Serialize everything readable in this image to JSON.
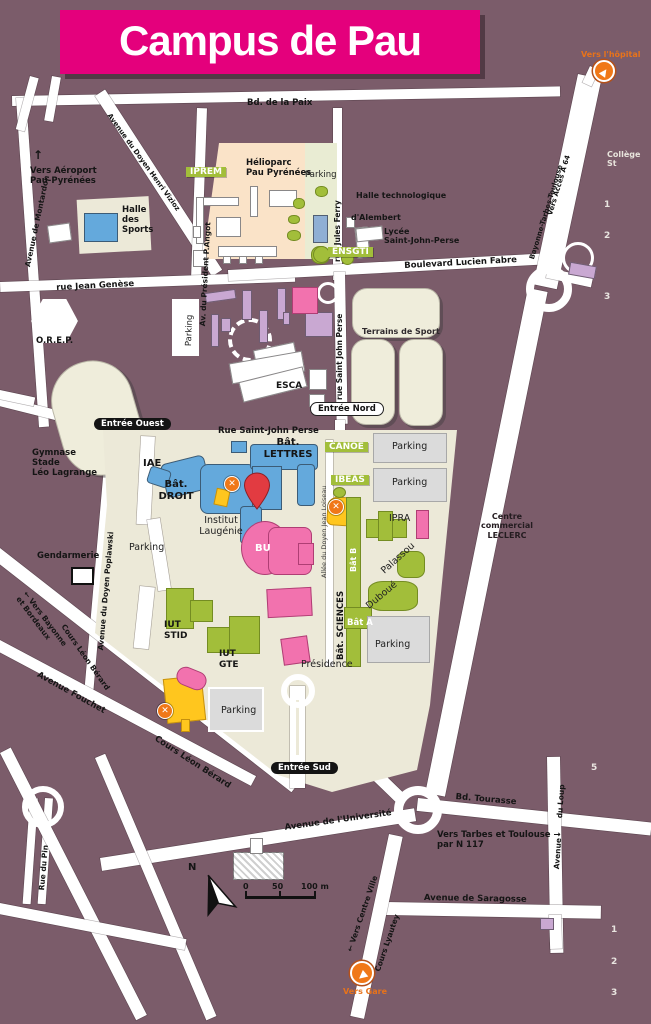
{
  "title": "Campus de Pau",
  "colors": {
    "banner_pink": "#E4007C",
    "background": "#7B5C6A",
    "campus_cream": "#ECE9D8",
    "heliopark_peach": "#FAE3C8",
    "road_white": "#FFFFFF",
    "building_blue": "#64A9DC",
    "building_pink": "#F272AE",
    "building_green": "#A2BE3A",
    "building_yellow": "#FFC61E",
    "building_lilac": "#C9A8D2",
    "parking_gray": "#DBDBDB",
    "marker_orange": "#F07818",
    "pin_red": "#E23B41"
  },
  "entrances": {
    "ouest": "Entrée Ouest",
    "nord": "Entrée Nord",
    "sud": "Entrée Sud"
  },
  "directions": {
    "hopital": "Vers l'hôpital",
    "gare": "Vers Gare",
    "aeroport": "Vers Aéroport\nPau-Pyrénées",
    "up_arrow": "↑",
    "bayonne": "← Vers Bayonne\net Bordeaux",
    "centre_ville": "← Vers Centre Ville",
    "tarbes": "Vers Tarbes et Toulouse  →\npar N 117",
    "acces_a64": "Vers Accès A 64",
    "axe_a64": "Bayonne-Tarbes-Toulouse"
  },
  "streets": {
    "paix": "Bd. de la Paix",
    "montardon": "Avenue de Montardon",
    "vizioz": "Avenue du Doyen Henri Vizioz",
    "angot": "Av. du Président P.Angot",
    "jules_ferry": "rue   Jules   Ferry",
    "genese": "rue Jean Genèse",
    "lucien_fabre": "Boulevard Lucien Fabre",
    "st_john_perse_v": "rue  Saint  John  Perse",
    "st_john_perse_h": "Rue Saint-John Perse",
    "loiseau": "Allée du Doyen Jean Loiseau",
    "poplawski": "Avenue du Doyen Poplawski",
    "leon_berard": "Cours Léon Bérard",
    "fouchet": "Avenue Fouchet",
    "tourasse": "Bd. Tourasse",
    "universite": "Avenue de l'Université",
    "loup_top": "du Loup",
    "loup_bottom": "Avenue",
    "saragosse": "Avenue de Saragosse",
    "lyautey": "Cours Lyautey",
    "pin": "Rue du Pin"
  },
  "places": {
    "iprem": "IPREM",
    "helioparc": "Hélioparc\nPau Pyrénées",
    "halle_technologique": "Halle technologique",
    "alembert": "d'Alembert",
    "lycee": "Lycée\nSaint-John-Perse",
    "ensgti": "ENSGTI",
    "halle_sports": "Halle\ndes\nSports",
    "orep": "O.R.E.P.",
    "esca": "ESCA",
    "terrains": "Terrains de Sport",
    "bat_lettres": "Bât.\nLETTRES",
    "iae": "IAE",
    "bat_droit": "Bât.\nDROIT",
    "laugenie": "Institut\nLaugénie",
    "bu": "BU",
    "canoe": "CANOE",
    "ibeas": "IBEAS",
    "ipra": "IPRA",
    "palassou": "Palassou",
    "duboue": "Duboué",
    "bat_b": "Bât B",
    "bat_a": "Bât A",
    "bat_sciences": "Bât. SCIENCES",
    "presidence": "Présidence",
    "iut_stid": "IUT\nSTID",
    "iut_gte": "IUT\nGTE",
    "gymnase": "Gymnase\nStade\nLéo Lagrange",
    "gendarmerie": "Gendarmerie",
    "leclerc": "Centre\ncommercial\nLECLERC",
    "college": "Collège St"
  },
  "labels": {
    "parking": "Parking"
  },
  "numbers": {
    "r1": "1",
    "r2": "2",
    "r3": "3",
    "mid": "5",
    "b1": "1",
    "b2": "2",
    "b3": "3"
  },
  "compass": {
    "north": "N"
  },
  "scale": {
    "zero": "0",
    "fifty": "50",
    "hundred": "100 m"
  }
}
